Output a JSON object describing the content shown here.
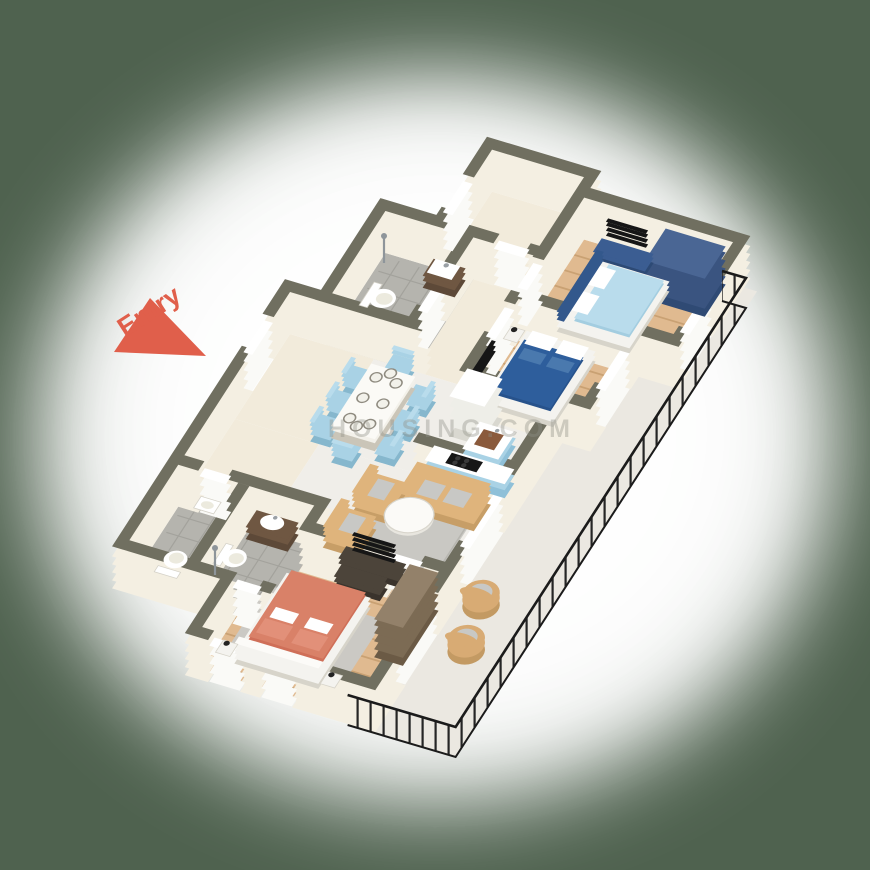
{
  "scene": {
    "type": "3d-floor-plan",
    "view": "isometric-top",
    "unit": "3BHK apartment with wrap-around balcony"
  },
  "labels": {
    "entry": "Entry",
    "watermark": "HOUSING.COM"
  },
  "colors": {
    "bg": "#4f624f",
    "halo": "#ffffff",
    "wall_top": "#706f60",
    "wall_face": "#f4efe2",
    "glazing": "#fafaf7",
    "floor_cream": "#f2ebdb",
    "floor_marble": "#f0eee9",
    "floor_balcony": "#ebe8e1",
    "floor_wood": "#e0ba90",
    "wood_line": "#c9a173",
    "floor_tile": "#b5b4ae",
    "tile_line": "#a3a29c",
    "rug": "#c9c8c3",
    "rug2": "#cbc9c4",
    "sofa": "#dfb47c",
    "sofa_dark": "#c79e67",
    "cushion": "#c8c8c5",
    "bed1_duvet": "#b9dcec",
    "bed_navy": "#33588c",
    "bed2_duvet": "#2e5e9c",
    "wardrobe_blue": "#3a5480",
    "wardrobe_blue_top": "#4a6694",
    "coral": "#d98168",
    "coral_dark": "#cf6f58",
    "white_furn": "#f4f3ef",
    "wood_dark": "#6f5742",
    "console_dark": "#4c443a",
    "kitchen_blue": "#a9d2e5",
    "fridge": "#eeeee8",
    "copper": "#8a5a3c",
    "chrome": "#8e959a",
    "tan_chair": "#d8ab74",
    "railing": "#1b1b1b",
    "entry_red": "#e05f4b",
    "watermark": "#8f8f86"
  },
  "rooms": [
    {
      "id": "store-room",
      "floor": "cream",
      "furniture": []
    },
    {
      "id": "bedroom-1",
      "floor": "wood",
      "furniture": [
        "double-bed-lightblue",
        "wardrobe-blue",
        "tv-unit",
        "wall-tv",
        "balcony-door"
      ]
    },
    {
      "id": "bathroom-1",
      "floor": "tile",
      "furniture": [
        "toilet",
        "vanity-washbasin",
        "shower"
      ]
    },
    {
      "id": "hallway",
      "floor": "cream",
      "furniture": []
    },
    {
      "id": "bedroom-2",
      "floor": "wood",
      "furniture": [
        "double-bed-navy",
        "nightstand-lamp",
        "wall-tv",
        "window"
      ]
    },
    {
      "id": "kitchen",
      "floor": "marble",
      "furniture": [
        "refrigerator",
        "sink-unit-copper-basin",
        "hob-counter"
      ]
    },
    {
      "id": "dining-area",
      "floor": "marble",
      "furniture": [
        "dining-table",
        "chairs-x8",
        "plates-x8"
      ]
    },
    {
      "id": "entry-foyer",
      "floor": "cream",
      "furniture": [
        "entry-door"
      ]
    },
    {
      "id": "corridor",
      "floor": "cream",
      "furniture": []
    },
    {
      "id": "bathroom-2",
      "floor": "tile",
      "furniture": [
        "toilet",
        "washbasin"
      ]
    },
    {
      "id": "bathroom-3",
      "floor": "tile",
      "furniture": [
        "vanity-washbasin",
        "toilet",
        "shower"
      ]
    },
    {
      "id": "living-room",
      "floor": "marble",
      "furniture": [
        "three-seat-sofa",
        "armchair",
        "armchair",
        "round-coffee-table",
        "rug",
        "tv-console",
        "tv"
      ]
    },
    {
      "id": "master-bedroom",
      "floor": "wood",
      "furniture": [
        "double-bed-coral",
        "nightstand-x2",
        "wardrobe-brown",
        "dresser",
        "rug",
        "windows-x2",
        "balcony-slider"
      ]
    },
    {
      "id": "balcony",
      "floor": "marble",
      "furniture": [
        "lounge-chair",
        "lounge-chair",
        "metal-railing"
      ]
    }
  ]
}
